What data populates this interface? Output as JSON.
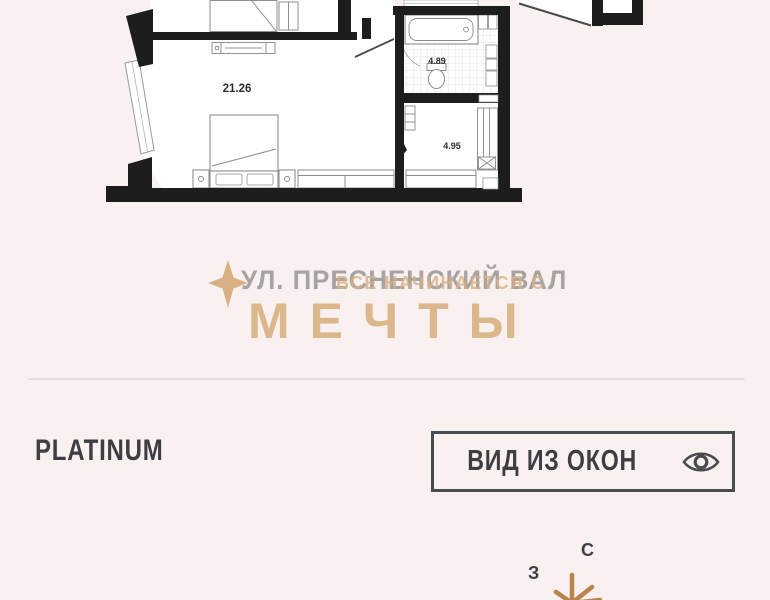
{
  "page": {
    "background": "#f8f1ef"
  },
  "floorplan": {
    "description": "apartment-floor-plan-top-cut",
    "wall_color": "#1d1d1d",
    "room_fill": "#ffffff",
    "rooms": [
      {
        "name": "living-room",
        "area_label": "21.26"
      },
      {
        "name": "bathroom",
        "area_label": "4.89"
      },
      {
        "name": "hallway",
        "area_label": "4.95"
      }
    ]
  },
  "branding": {
    "address": "УЛ. ПРЕСНЕНСКИЙ ВАЛ",
    "slogan_line": "ВСЕ НАЧИНАЕТСЯ С",
    "slogan_word": "МЕЧТЫ",
    "accent_color": "#d8b083",
    "gray_color": "#a7a3a2",
    "star_icon": "four-point-sparkle"
  },
  "listing": {
    "tier_label": "PLATINUM",
    "view_button_label": "ВИД ИЗ ОКОН",
    "view_button_icon": "eye-icon"
  },
  "compass": {
    "north_label": "С",
    "west_label": "З",
    "star_color": "#b9834d"
  }
}
